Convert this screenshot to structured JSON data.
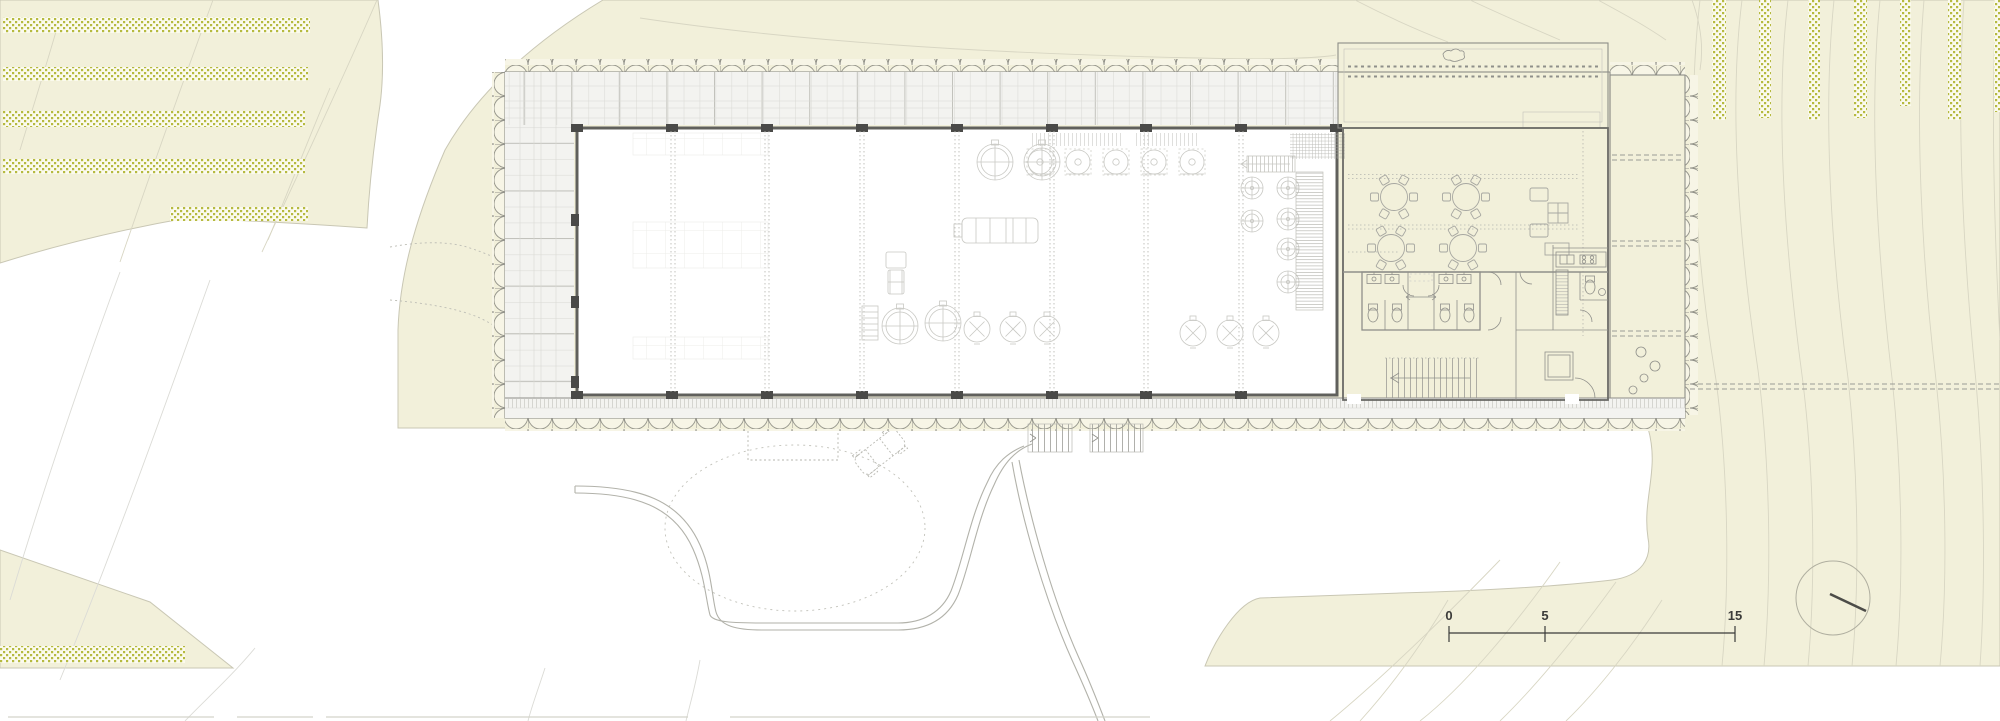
{
  "drawing": {
    "kind": "architectural-site-plan",
    "subject": "winery ground floor plan with vineyard terrain, access driveway, scale bar and north arrow"
  },
  "scale_bar": {
    "labels": {
      "start": "0",
      "mid": "5",
      "end": "15"
    }
  },
  "colors": {
    "paper": "#ffffff",
    "terrain": "#f2f0da",
    "terrain_edge": "#c9c7b4",
    "vine_band_bg": "#fbfaee",
    "vine_dot": "#b6ba40",
    "contour_on_terrain": "#d8d6c3",
    "contour_on_white": "#dbdbd6",
    "road_line": "#b2b2aa",
    "building_line": "#8d8d88",
    "wall": "#60605c",
    "corridor_fill": "#f3f3f0",
    "annex_fill": "#f0f0eb",
    "scallop_fill": "#f7f5e6",
    "equipment_line": "#c8c8c3",
    "furniture_line": "#a7a7a1",
    "north_needle": "#4c4c48",
    "scale_text": "#3b3b39"
  },
  "symbols": {
    "north_arrow": "circle with needle",
    "scale_units": "drawing scale ticks",
    "vineyard_rows": "dotted planting bands",
    "turning_circle": "dotted vehicle turning path"
  }
}
